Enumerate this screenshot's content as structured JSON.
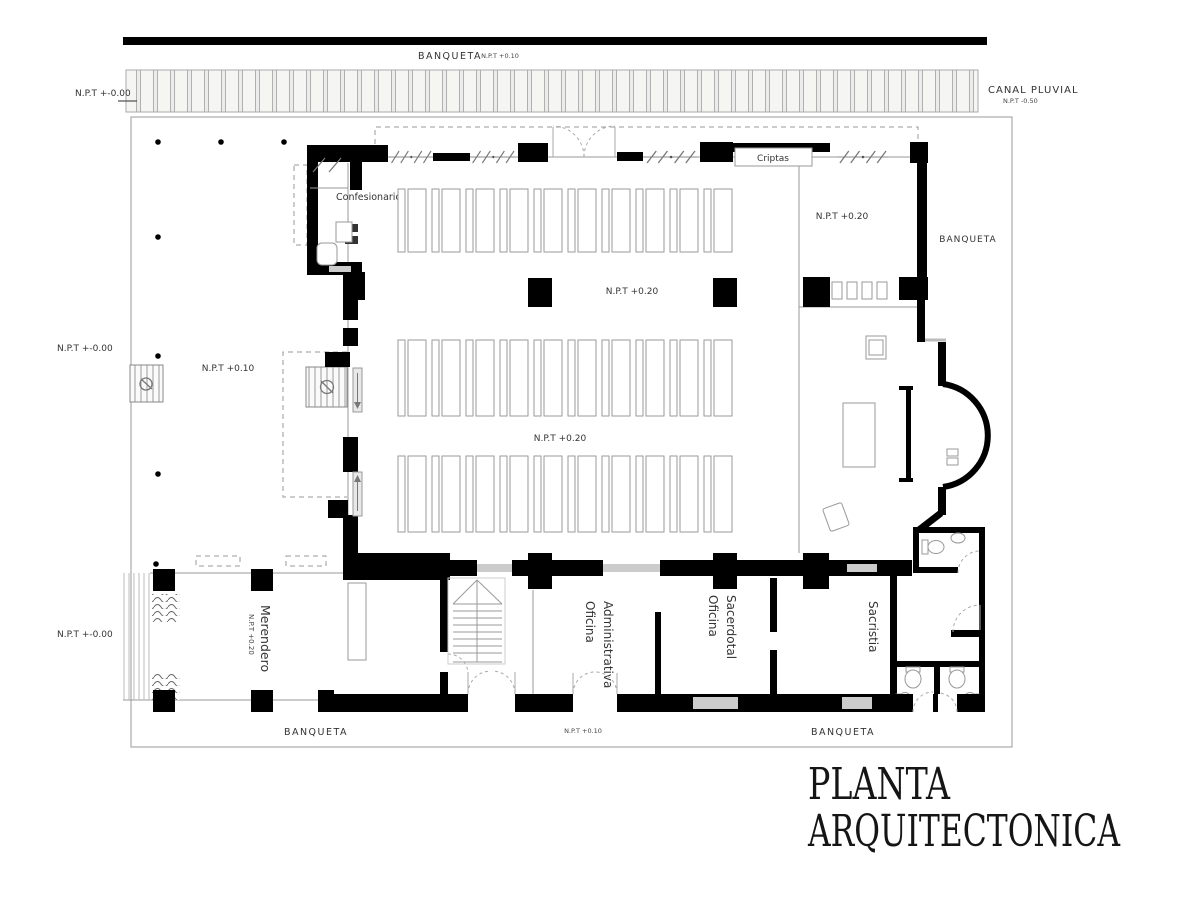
{
  "title": {
    "line1": "PLANTA",
    "line2": "ARQUITECTONICA"
  },
  "labels": {
    "banqueta": "BANQUETA",
    "npt_zero": "N.P.T +-0.00",
    "npt_10": "N.P.T +0.10",
    "npt_20": "N.P.T +0.20",
    "canal_pluvial": "CANAL PLUVIAL",
    "canal_npt": "N.P.T -0.50"
  },
  "rooms": {
    "confesionario": "Confesionario",
    "criptas": "Criptas",
    "merendero": "Merendero",
    "sacristia": "Sacristia",
    "oficina_administrativa": [
      "Oficina",
      "Administrativa"
    ],
    "oficina_sacerdotal": [
      "Oficina",
      "Sacerdotal"
    ]
  },
  "nave": {
    "pews_per_row": 10,
    "pew_x0": 398,
    "pew_pitch": 34,
    "pew_banks": [
      {
        "y": 189,
        "h": 63
      },
      {
        "y": 340,
        "h": 76
      },
      {
        "y": 456,
        "h": 76
      }
    ]
  }
}
